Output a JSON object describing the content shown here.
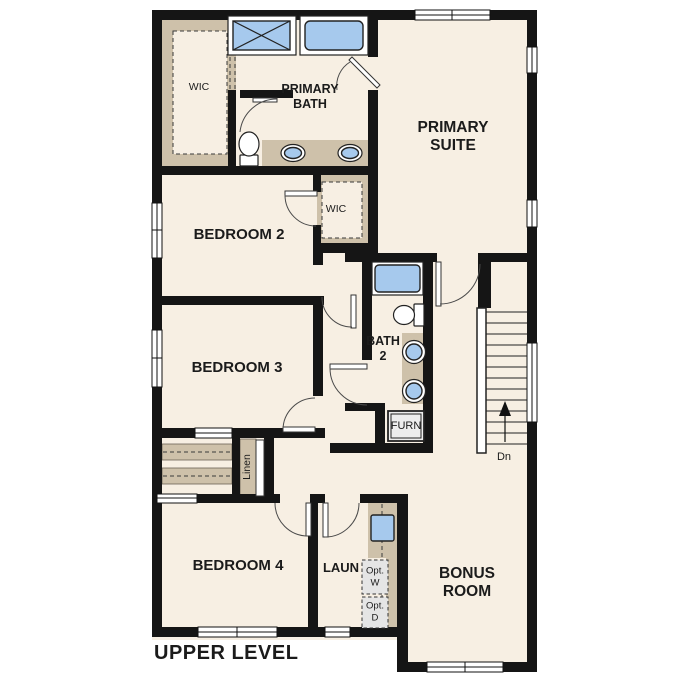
{
  "title": "UPPER LEVEL",
  "rooms": {
    "wic_primary": {
      "label": "WIC"
    },
    "primary_bath": {
      "lines": [
        "PRIMARY",
        "BATH"
      ]
    },
    "primary_suite": {
      "lines": [
        "PRIMARY",
        "SUITE"
      ]
    },
    "bedroom_2": {
      "label": "BEDROOM 2"
    },
    "wic_bedroom_2": {
      "label": "WIC"
    },
    "bedroom_3": {
      "label": "BEDROOM 3"
    },
    "bath_2": {
      "lines": [
        "BATH",
        "2"
      ]
    },
    "furnace": {
      "label": "FURN"
    },
    "linen": {
      "label": "Linen"
    },
    "bedroom_4": {
      "label": "BEDROOM 4"
    },
    "laundry": {
      "label": "LAUN"
    },
    "optional_washer": {
      "lines": [
        "Opt.",
        "W"
      ]
    },
    "optional_dryer": {
      "lines": [
        "Opt.",
        "D"
      ]
    },
    "bonus_room": {
      "lines": [
        "BONUS",
        "ROOM"
      ]
    }
  },
  "stairs": {
    "direction_label": "Dn"
  },
  "colors": {
    "wall": "#151515",
    "floor": "#f7efe3",
    "casework": "#cec1aa",
    "fixture": "#a6c9ed",
    "appliance": "#e5e5e5",
    "background": "#ffffff"
  }
}
